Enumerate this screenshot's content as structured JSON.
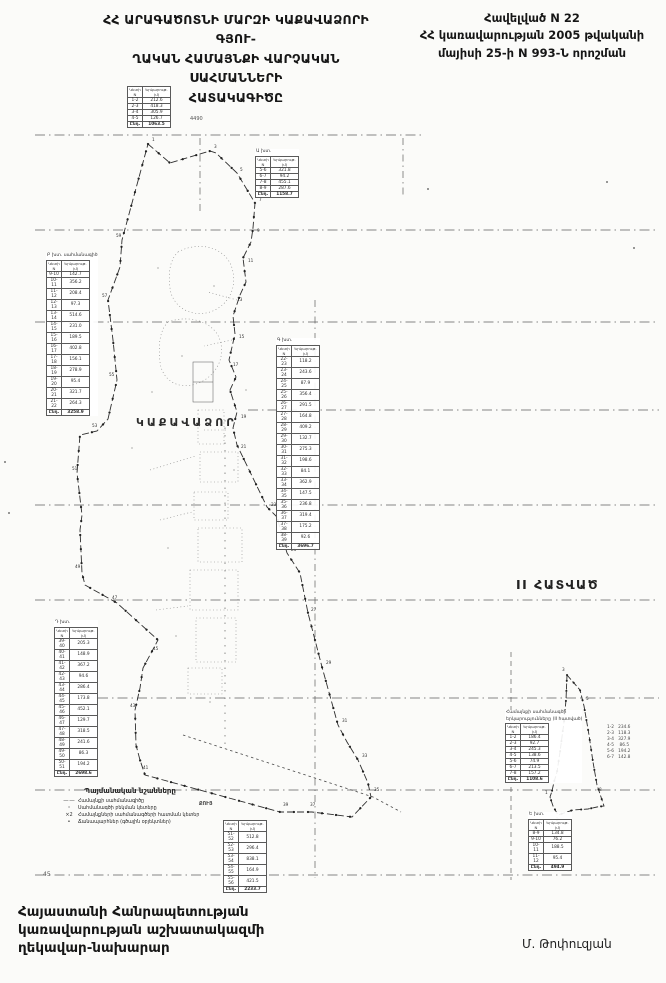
{
  "header": {
    "title_lines": [
      "ՀՀ ԱՐԱԳԱԾՈՏՆԻ ՄԱՐԶԻ ԿԱՔԱՎԱՁՈՐԻ ԳՅՈՒ-",
      "ՂԱԿԱՆ ՀԱՄԱՅՆՔԻ ՎԱՐՉԱԿԱՆ ՍԱՀՄԱՆՆԵՐԻ",
      "ՀԱՏԱԿԱԳԻԾԸ"
    ],
    "annex_lines": [
      "Հավելված N 22",
      "ՀՀ կառավարության 2005 թվականի",
      "մայիսի 25-ի N 993-Ն որոշման"
    ]
  },
  "map": {
    "village_label": "ԿԱՔԱՎԱՁՈՐ",
    "section_label": "II ՀԱՏՎԱԾ",
    "grid_labels": {
      "top": "4490",
      "bottom": "45"
    },
    "legend": {
      "title": "Պայմանական նշանները",
      "items": [
        {
          "sym": "—·—",
          "label": "Համայնքի սահմանագիծը"
        },
        {
          "sym": "⹀",
          "label": "Սահմանագծի բեկման կետերը"
        },
        {
          "sym": "×2",
          "label": "Համայնքների սահմանագծերի հատման կետեր"
        },
        {
          "sym": "•",
          "label": "Ճանապարհներ (գծային օբյեկտներ)"
        }
      ],
      "side_note": "ՔՈՒՅ"
    },
    "tables": [
      {
        "caption": "",
        "cols": [
          "Կետի N",
          "Երկարութ. (մ)"
        ],
        "total_label": "Ընդ.",
        "rows": [
          [
            "1-2",
            "212.6"
          ],
          [
            "2-3",
            "418.3"
          ],
          [
            "3-4",
            "305.9"
          ],
          [
            "4-5",
            "126.7"
          ]
        ],
        "total": "1063.5"
      },
      {
        "caption": "Ա խտ.",
        "cols": [
          "Կետի N",
          "Երկարութ. (մ)"
        ],
        "total_label": "Ընդ.",
        "rows": [
          [
            "5-6",
            "321.8"
          ],
          [
            "6-7",
            "94.2"
          ],
          [
            "7-8",
            "455.1"
          ],
          [
            "8-9",
            "287.6"
          ]
        ],
        "total": "1158.7"
      },
      {
        "caption": "Բ խտ. սահմանագիծ",
        "cols": [
          "Կետի N",
          "Երկարութ. (մ)"
        ],
        "total_label": "Ընդ.",
        "rows": [
          [
            "9-10",
            "142.7"
          ],
          [
            "10-11",
            "356.2"
          ],
          [
            "11-12",
            "208.4"
          ],
          [
            "12-13",
            "97.3"
          ],
          [
            "13-14",
            "514.6"
          ],
          [
            "14-15",
            "231.0"
          ],
          [
            "15-16",
            "189.5"
          ],
          [
            "16-17",
            "402.8"
          ],
          [
            "17-18",
            "156.1"
          ],
          [
            "18-19",
            "278.9"
          ],
          [
            "19-20",
            "95.4"
          ],
          [
            "20-21",
            "321.7"
          ],
          [
            "21-22",
            "264.3"
          ]
        ],
        "total": "3258.9"
      },
      {
        "caption": "Գ խտ.",
        "cols": [
          "Կետի N",
          "Երկարութ. (մ)"
        ],
        "total_label": "Ընդ.",
        "rows": [
          [
            "22-23",
            "118.2"
          ],
          [
            "23-24",
            "243.6"
          ],
          [
            "24-25",
            "87.9"
          ],
          [
            "25-26",
            "356.4"
          ],
          [
            "26-27",
            "291.5"
          ],
          [
            "27-28",
            "164.8"
          ],
          [
            "28-29",
            "409.2"
          ],
          [
            "29-30",
            "132.7"
          ],
          [
            "30-31",
            "275.3"
          ],
          [
            "31-32",
            "198.6"
          ],
          [
            "32-33",
            "84.1"
          ],
          [
            "33-34",
            "362.9"
          ],
          [
            "34-35",
            "147.5"
          ],
          [
            "35-36",
            "236.8"
          ],
          [
            "36-37",
            "319.4"
          ],
          [
            "37-38",
            "175.2"
          ],
          [
            "38-39",
            "92.6"
          ]
        ],
        "total": "3696.7"
      },
      {
        "caption": "Դ խտ.",
        "cols": [
          "Կետի N",
          "Երկարութ. (մ)"
        ],
        "total_label": "Ընդ.",
        "rows": [
          [
            "39-40",
            "205.3"
          ],
          [
            "40-41",
            "148.9"
          ],
          [
            "41-42",
            "367.2"
          ],
          [
            "42-43",
            "94.6"
          ],
          [
            "43-44",
            "286.4"
          ],
          [
            "44-45",
            "173.8"
          ],
          [
            "45-46",
            "452.1"
          ],
          [
            "46-47",
            "129.7"
          ],
          [
            "47-48",
            "318.5"
          ],
          [
            "48-49",
            "241.6"
          ],
          [
            "49-50",
            "86.3"
          ],
          [
            "50-51",
            "194.2"
          ]
        ],
        "total": "2698.6"
      },
      {
        "caption": "",
        "cols": [
          "Կետի N",
          "Երկարութ. (մ)"
        ],
        "total_label": "Ընդ.",
        "rows": [
          [
            "51-52",
            "512.8"
          ],
          [
            "52-53",
            "296.4"
          ],
          [
            "53-54",
            "838.1"
          ],
          [
            "54-55",
            "164.9"
          ],
          [
            "55-56",
            "421.5"
          ]
        ],
        "total": "2233.7"
      },
      {
        "caption": [
          "Համայնքի սահմանագծի",
          "երկարությունները (II հատված)"
        ],
        "cols": [
          "Կետի N",
          "Երկարութ. (մ)"
        ],
        "total_label": "Ընդ.",
        "rows": [
          [
            "1-2",
            "186.4"
          ],
          [
            "2-3",
            "92.7"
          ],
          [
            "3-4",
            "245.3"
          ],
          [
            "4-5",
            "138.6"
          ],
          [
            "5-6",
            "74.9"
          ],
          [
            "6-7",
            "213.5"
          ],
          [
            "7-8",
            "157.2"
          ]
        ],
        "total": "1108.6"
      },
      {
        "caption": "Ե խտ.",
        "cols": [
          "Կետի N",
          "Երկարութ. (մ)"
        ],
        "total_label": "Ընդ.",
        "rows": [
          [
            "8-9",
            "134.8"
          ],
          [
            "9-10",
            "76.2"
          ],
          [
            "10-11",
            "188.5"
          ],
          [
            "11-12",
            "95.4"
          ]
        ],
        "total": "494.9"
      }
    ],
    "plain_block_lines": [
      "1-2   234.6",
      "2-3   118.3",
      "3-4   327.9",
      "4-5    86.5",
      "5-6   194.2",
      "6-7   142.8"
    ],
    "boundary_points": [
      {
        "n": "1",
        "x": 152,
        "y": 141
      },
      {
        "n": "3",
        "x": 214,
        "y": 148
      },
      {
        "n": "5",
        "x": 240,
        "y": 171
      },
      {
        "n": "7",
        "x": 259,
        "y": 201
      },
      {
        "n": "9",
        "x": 257,
        "y": 232
      },
      {
        "n": "11",
        "x": 248,
        "y": 262
      },
      {
        "n": "13",
        "x": 237,
        "y": 301
      },
      {
        "n": "15",
        "x": 239,
        "y": 338
      },
      {
        "n": "17",
        "x": 233,
        "y": 366
      },
      {
        "n": "19",
        "x": 241,
        "y": 418
      },
      {
        "n": "21",
        "x": 241,
        "y": 448
      },
      {
        "n": "23",
        "x": 271,
        "y": 506
      },
      {
        "n": "25",
        "x": 291,
        "y": 551
      },
      {
        "n": "27",
        "x": 311,
        "y": 611
      },
      {
        "n": "29",
        "x": 326,
        "y": 664
      },
      {
        "n": "31",
        "x": 342,
        "y": 722
      },
      {
        "n": "33",
        "x": 362,
        "y": 757
      },
      {
        "n": "35",
        "x": 374,
        "y": 791
      },
      {
        "n": "37",
        "x": 310,
        "y": 806
      },
      {
        "n": "39",
        "x": 283,
        "y": 806
      },
      {
        "n": "41",
        "x": 143,
        "y": 769
      },
      {
        "n": "43",
        "x": 130,
        "y": 707
      },
      {
        "n": "45",
        "x": 153,
        "y": 650
      },
      {
        "n": "47",
        "x": 112,
        "y": 599
      },
      {
        "n": "49",
        "x": 75,
        "y": 568
      },
      {
        "n": "51",
        "x": 72,
        "y": 470
      },
      {
        "n": "53",
        "x": 92,
        "y": 427
      },
      {
        "n": "55",
        "x": 109,
        "y": 376
      },
      {
        "n": "57",
        "x": 102,
        "y": 297
      },
      {
        "n": "59",
        "x": 116,
        "y": 237
      },
      {
        "n": "1",
        "x": 545,
        "y": 794
      },
      {
        "n": "2",
        "x": 556,
        "y": 821
      },
      {
        "n": "3",
        "x": 562,
        "y": 671
      },
      {
        "n": "5",
        "x": 586,
        "y": 700
      },
      {
        "n": "8",
        "x": 599,
        "y": 791
      }
    ]
  },
  "footer": {
    "official_lines": [
      "Հայաստանի Հանրապետության",
      "կառավարության աշխատակազմի",
      "ղեկավար-նախարար"
    ],
    "signature": "Մ. Թոփուզյան"
  }
}
